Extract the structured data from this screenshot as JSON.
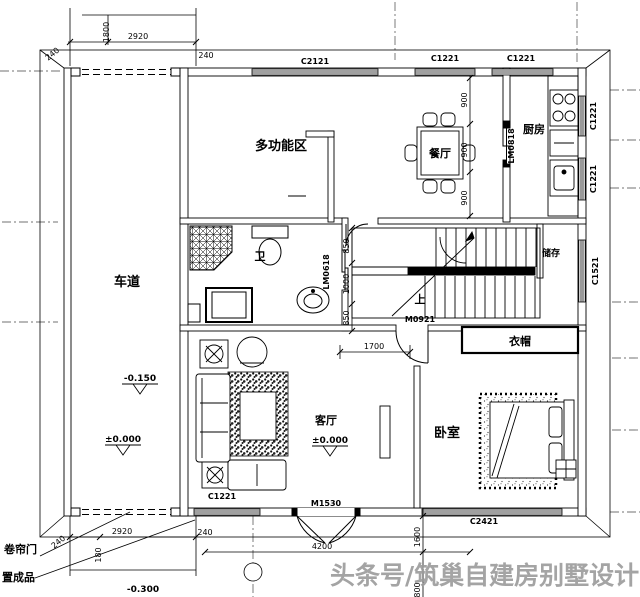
{
  "plan": {
    "watermark": "头条号/筑巢自建房别墅设计",
    "rooms": {
      "driveway": "车道",
      "multifunction": "多功能区",
      "dining": "餐厅",
      "kitchen": "厨房",
      "bath": "卫",
      "storage": "储存",
      "up": "上",
      "cloakroom": "衣帽",
      "living": "客厅",
      "bedroom": "卧室"
    },
    "windows": {
      "top1": "C2121",
      "top2": "C1221",
      "top3": "C1221",
      "right1": "C1221",
      "right2": "C1221",
      "right3": "C1521",
      "bottom_living": "C1221",
      "bottom_bedroom": "C2421"
    },
    "doors": {
      "entry": "M1530",
      "hall": "M0921",
      "kitchen": "LM0818",
      "bath": "LM0618"
    },
    "dims": {
      "top_1800": "1800",
      "top_2920": "2920",
      "top_240l": "240",
      "top_240r": "240",
      "d900a": "900",
      "d900b": "900",
      "d900c": "900",
      "s850a": "850",
      "s1000": "1000",
      "s850b": "850",
      "hall_1700": "1700",
      "b240l": "240",
      "b2920": "2920",
      "b180": "180",
      "b240r": "240",
      "b4200": "4200",
      "b1600": "1600",
      "b800": "800"
    },
    "elevations": {
      "drive_upper": "-0.150",
      "drive_lower": "±0.000",
      "living": "±0.000",
      "outside": "-0.300"
    },
    "notes": {
      "shutter": "卷帘门",
      "product": "置成品"
    }
  }
}
